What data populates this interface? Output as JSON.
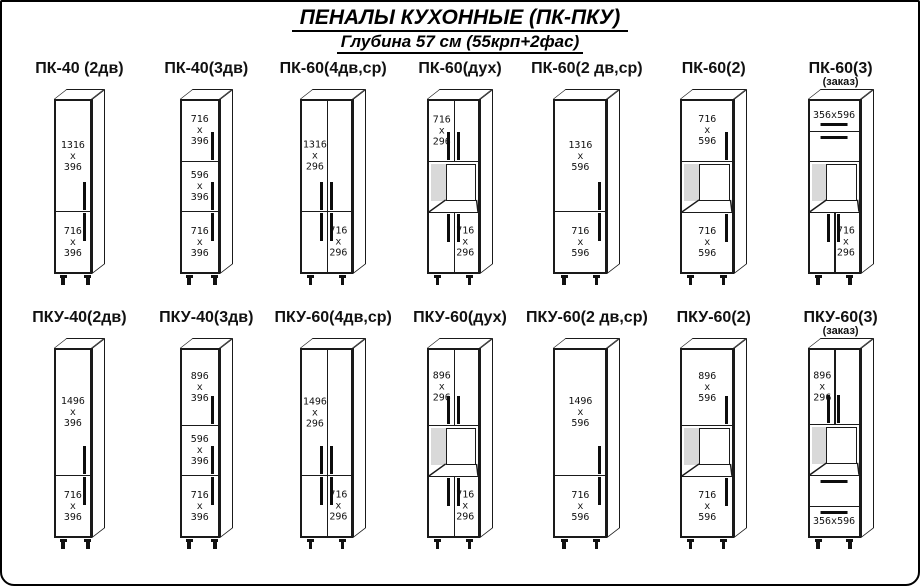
{
  "header": {
    "title": "ПЕНАЛЫ  КУХОННЫЕ (ПК-ПКУ)",
    "subtitle": "Глубина 57 см (55крп+2фас)"
  },
  "colors": {
    "line": "#1a1a1a",
    "background": "#ffffff",
    "niche_shade": "#d9d9d9"
  },
  "rows": [
    {
      "cabinets": [
        {
          "title": "ПК-40 (2дв)",
          "w": 38,
          "h": 175,
          "sections": [
            {
              "type": "door",
              "h": 1316,
              "label": "1316 х 396",
              "handle": "rb"
            },
            {
              "type": "door",
              "h": 716,
              "label": "716 х 396",
              "handle": "rt"
            }
          ]
        },
        {
          "title": "ПК-40(3дв)",
          "w": 40,
          "h": 175,
          "sections": [
            {
              "type": "door",
              "h": 716,
              "label": "716 х 396",
              "handle": "rb"
            },
            {
              "type": "door",
              "h": 596,
              "label": "596 х 396",
              "handle": "rb"
            },
            {
              "type": "door",
              "h": 716,
              "label": "716 х 396",
              "handle": "rt"
            }
          ]
        },
        {
          "title": "ПК-60(4дв,ср)",
          "w": 53,
          "h": 175,
          "sections": [
            {
              "type": "double",
              "h": 1316,
              "label": "1316 х 296",
              "labelSide": "left",
              "handle": "cb"
            },
            {
              "type": "double",
              "h": 716,
              "label": "716 х 296",
              "labelSide": "right",
              "handle": "ct"
            }
          ]
        },
        {
          "title": "ПК-60(дух)",
          "w": 53,
          "h": 175,
          "sections": [
            {
              "type": "double",
              "h": 716,
              "label": "716 х 296",
              "labelSide": "left",
              "handle": "cb"
            },
            {
              "type": "niche",
              "h": 600
            },
            {
              "type": "double",
              "h": 716,
              "label": "716 х 296",
              "labelSide": "right",
              "handle": "ct"
            }
          ]
        },
        {
          "title": "ПК-60(2 дв,ср)",
          "w": 54,
          "h": 175,
          "sections": [
            {
              "type": "door",
              "h": 1316,
              "label": "1316 х 596",
              "handle": "rb"
            },
            {
              "type": "door",
              "h": 716,
              "label": "716 х 596",
              "handle": "rt"
            }
          ]
        },
        {
          "title": "ПК-60(2)",
          "w": 54,
          "h": 175,
          "sections": [
            {
              "type": "door",
              "h": 716,
              "label": "716 х 596",
              "handle": "rb"
            },
            {
              "type": "niche",
              "h": 600
            },
            {
              "type": "door",
              "h": 716,
              "label": "716 х 596",
              "handle": "rt"
            }
          ]
        },
        {
          "title": "ПК-60(3)",
          "subtitle": "(заказ)",
          "w": 53,
          "h": 175,
          "sections": [
            {
              "type": "drawer",
              "h": 356,
              "label": "356х596",
              "handle": "hb"
            },
            {
              "type": "drawer",
              "h": 356,
              "handle": "ht"
            },
            {
              "type": "niche",
              "h": 600
            },
            {
              "type": "double",
              "h": 716,
              "label": "716 х 296",
              "labelSide": "right",
              "handle": "ct"
            }
          ]
        }
      ]
    },
    {
      "cabinets": [
        {
          "title": "ПКУ-40(2дв)",
          "w": 38,
          "h": 190,
          "sections": [
            {
              "type": "door",
              "h": 1496,
              "label": "1496 х 396",
              "handle": "rb"
            },
            {
              "type": "door",
              "h": 716,
              "label": "716 х 396",
              "handle": "rt"
            }
          ]
        },
        {
          "title": "ПКУ-40(3дв)",
          "w": 40,
          "h": 190,
          "sections": [
            {
              "type": "door",
              "h": 896,
              "label": "896 х 396",
              "handle": "rb"
            },
            {
              "type": "door",
              "h": 596,
              "label": "596 х 396",
              "handle": "rb"
            },
            {
              "type": "door",
              "h": 716,
              "label": "716 х 396",
              "handle": "rt"
            }
          ]
        },
        {
          "title": "ПКУ-60(4дв,ср)",
          "w": 53,
          "h": 190,
          "sections": [
            {
              "type": "double",
              "h": 1496,
              "label": "1496 х 296",
              "labelSide": "left",
              "handle": "cb"
            },
            {
              "type": "double",
              "h": 716,
              "label": "716 х 296",
              "labelSide": "right",
              "handle": "ct"
            }
          ]
        },
        {
          "title": "ПКУ-60(дух)",
          "w": 53,
          "h": 190,
          "sections": [
            {
              "type": "double",
              "h": 896,
              "label": "896 х 296",
              "labelSide": "left",
              "handle": "cb"
            },
            {
              "type": "niche",
              "h": 600
            },
            {
              "type": "double",
              "h": 716,
              "label": "716 х 296",
              "labelSide": "right",
              "handle": "ct"
            }
          ]
        },
        {
          "title": "ПКУ-60(2 дв,ср)",
          "w": 54,
          "h": 190,
          "sections": [
            {
              "type": "door",
              "h": 1496,
              "label": "1496 х 596",
              "handle": "rb"
            },
            {
              "type": "door",
              "h": 716,
              "label": "716 х 596",
              "handle": "rt"
            }
          ]
        },
        {
          "title": "ПКУ-60(2)",
          "w": 54,
          "h": 190,
          "sections": [
            {
              "type": "door",
              "h": 896,
              "label": "896 х 596",
              "handle": "rb"
            },
            {
              "type": "niche",
              "h": 600
            },
            {
              "type": "door",
              "h": 716,
              "label": "716 х 596",
              "handle": "rt"
            }
          ]
        },
        {
          "title": "ПКУ-60(3)",
          "subtitle": "(заказ)",
          "w": 53,
          "h": 190,
          "sections": [
            {
              "type": "double",
              "h": 896,
              "label": "896 х 296",
              "labelSide": "left",
              "handle": "cb"
            },
            {
              "type": "niche",
              "h": 600
            },
            {
              "type": "drawer",
              "h": 356,
              "handle": "ht"
            },
            {
              "type": "drawer",
              "h": 356,
              "label": "356х596",
              "handle": "ht"
            }
          ]
        }
      ]
    }
  ]
}
